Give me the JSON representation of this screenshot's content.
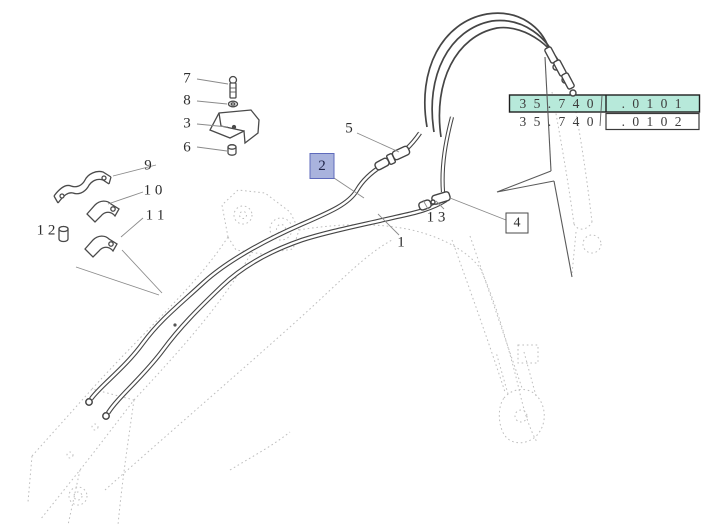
{
  "part_numbers": {
    "row1": {
      "prefix": "3 5 . 7 4 0",
      "suffix": ". 0 1 0 1",
      "highlighted": true
    },
    "row2": {
      "prefix": "3 5 . 7 4 0",
      "suffix": ". 0 1 0 2",
      "highlighted": false
    }
  },
  "callouts": {
    "c1": "1",
    "c2": "2",
    "c3": "3",
    "c4": "4",
    "c5": "5",
    "c6": "6",
    "c7": "7",
    "c8": "8",
    "c9": "9",
    "c10": "1 0",
    "c11": "1 1",
    "c12": "1 2",
    "c13": "1 3"
  },
  "colors": {
    "highlight_teal": "#b7e9da",
    "callout_blue_fill": "#a9b3dd",
    "callout_blue_border": "#5f6bbc",
    "solid_line": "#454545",
    "phantom_line": "#bdbdbd",
    "leader_line": "#8a8a8a",
    "text": "#2e2e2e"
  }
}
